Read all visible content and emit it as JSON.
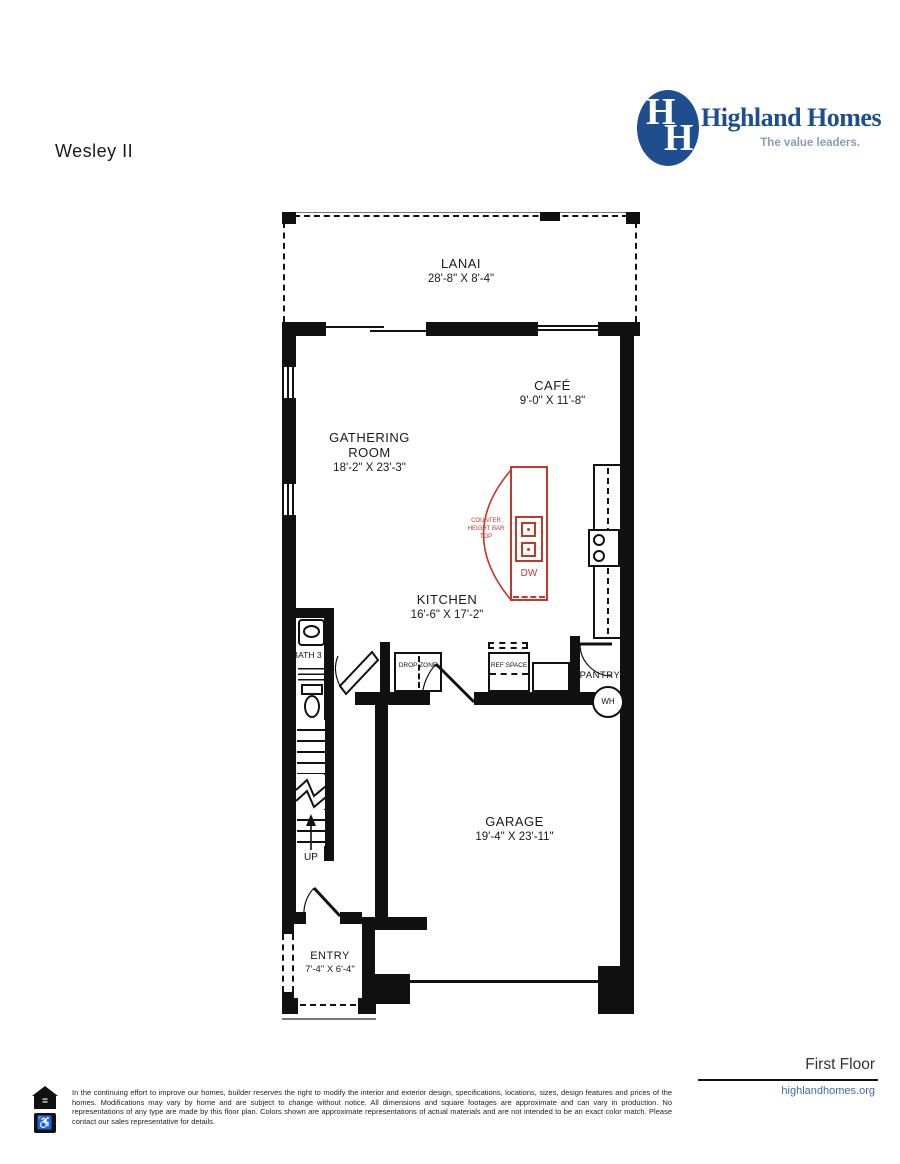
{
  "page": {
    "title": "Wesley II",
    "floor_label": "First Floor"
  },
  "brand": {
    "name": "Highland Homes",
    "tagline": "The value leaders.",
    "monogram_h1": "H",
    "monogram_h2": "H",
    "website": "highlandhomes.org"
  },
  "rooms": {
    "lanai": {
      "name": "LANAI",
      "dims": "28'-8\" X 8'-4\""
    },
    "cafe": {
      "name": "CAFÉ",
      "dims": "9'-0\" X 11'-8\""
    },
    "gathering": {
      "name": "GATHERING ROOM",
      "dims": "18'-2\" X 23'-3\""
    },
    "kitchen": {
      "name": "KITCHEN",
      "dims": "16'-6\" X 17'-2\""
    },
    "garage": {
      "name": "GARAGE",
      "dims": "19'-4\" X 23'-11\""
    },
    "entry": {
      "name": "ENTRY",
      "dims": "7'-4\" X 6'-4\""
    },
    "bath3": {
      "name": "BATH 3"
    },
    "pantry": {
      "name": "PANTRY"
    }
  },
  "annotations": {
    "counter_bar": "COUNTER HEIGHT BAR TOP",
    "dishwasher": "DW",
    "drop_zone": "DROP ZONE",
    "ref_space": "REF SPACE",
    "water_heater": "WH",
    "stairs_up": "UP"
  },
  "footer": {
    "disclaimer": "In the continuing effort to improve our homes, builder reserves the right to modify the interior and exterior design, specifications, locations, sizes, design features and prices of the homes. Modifications may vary by home and are subject to change without notice. All dimensions and square footages are approximate and can vary in production. No representations of any type are made by this floor plan. Colors shown are approximate representations of actual materials and are not intended to be an exact color match. Please contact our sales representative for details.",
    "website": "highlandhomes.org",
    "equal_housing_symbol": "=",
    "accessibility_symbol": "♿"
  },
  "colors": {
    "brand_blue": "#1e4e8e",
    "tagline_gray": "#8b9cb4",
    "plan_red": "#c0392b",
    "link_blue": "#3f6ea6",
    "wall_black": "#111111"
  }
}
